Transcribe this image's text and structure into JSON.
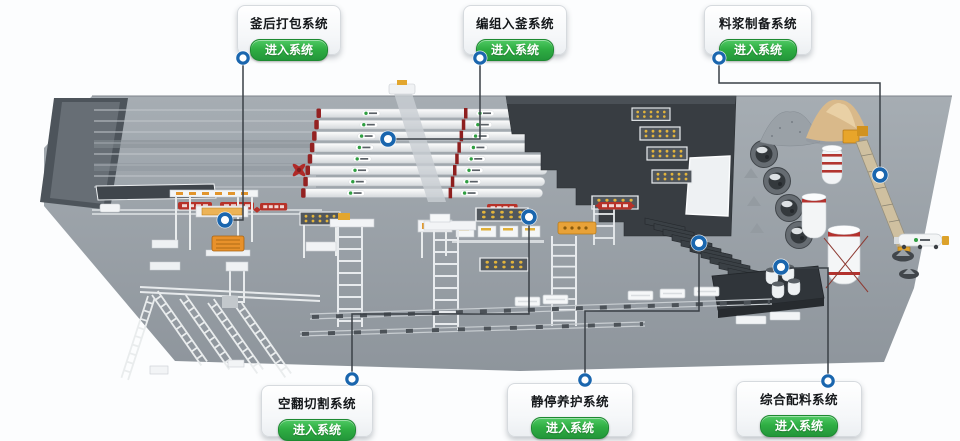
{
  "page": {
    "description": "3D factory overview dashboard of an AAC block plant with six system entry cards connected by leader lines to blue markers on the plant model"
  },
  "colors": {
    "accent_blue": "#1a66ae",
    "button_green": "#2fae43",
    "connector_line": "#3a4046",
    "ground_gray": "#9aa1a8",
    "dark_building": "#383d42",
    "banner_red": "#b73229"
  },
  "systems": [
    {
      "id": "post-autoclave-packing",
      "title": "釜后打包系统",
      "button": "进入系统"
    },
    {
      "id": "grouping-into-autoclave",
      "title": "编组入釜系统",
      "button": "进入系统"
    },
    {
      "id": "slurry-preparation",
      "title": "料浆制备系统",
      "button": "进入系统"
    },
    {
      "id": "flip-cutting",
      "title": "空翻切割系统",
      "button": "进入系统"
    },
    {
      "id": "pre-curing",
      "title": "静停养护系统",
      "button": "进入系统"
    },
    {
      "id": "integrated-batching",
      "title": "综合配料系统",
      "button": "进入系统"
    }
  ],
  "scene": {
    "icons": [
      "factory-ground",
      "left-walkway",
      "rail-lanes",
      "autoclave-tanks",
      "crane-bridge",
      "dark-curing-building",
      "mold-racks",
      "curing-louvres",
      "ball-mill-tanks",
      "gravel-pile",
      "sand-pile",
      "slurry-silos",
      "batching-platform",
      "conveyor-ramp",
      "tank-truck",
      "casting-pits",
      "route-banners",
      "gantry-crane",
      "transfer-trestles",
      "bottom-conveyors",
      "blue-location-markers"
    ]
  }
}
